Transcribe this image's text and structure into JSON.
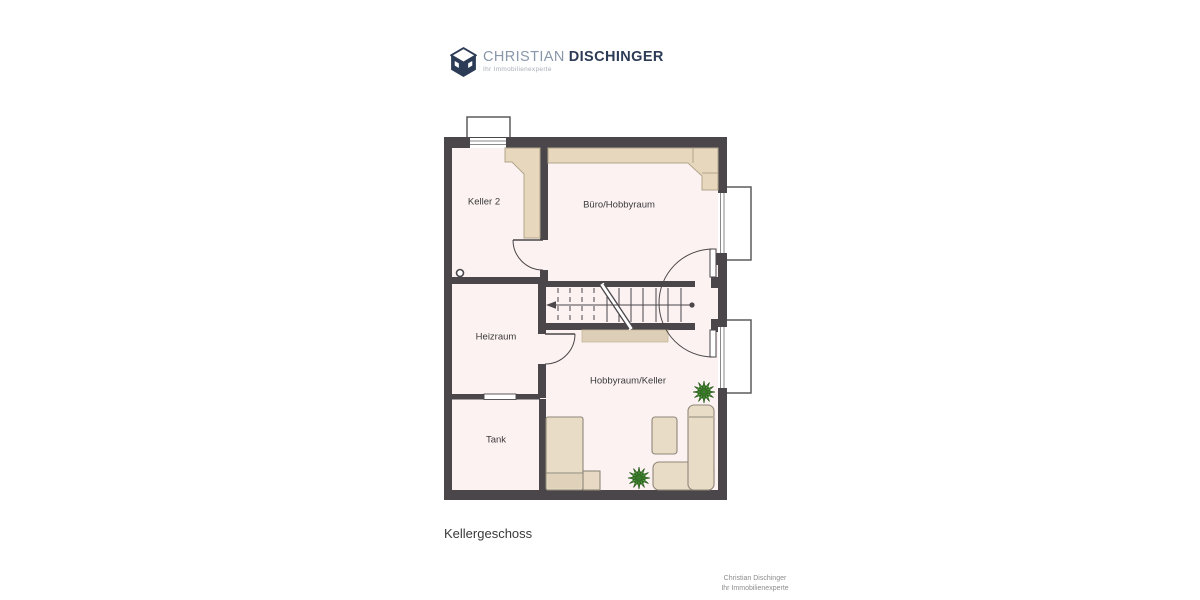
{
  "logo": {
    "brand_first": "CHRISTIAN",
    "brand_second": "DISCHINGER",
    "tagline": "Ihr Immobilienexperte"
  },
  "floorplan": {
    "title": "Kellergeschoss",
    "rooms": [
      {
        "label": "Keller 2"
      },
      {
        "label": "Büro/Hobbyraum"
      },
      {
        "label": "Heizraum"
      },
      {
        "label": "Hobbyraum/Keller"
      },
      {
        "label": "Tank"
      }
    ]
  },
  "footer": {
    "line1": "Christian Dischinger",
    "line2": "Ihr Immobilienexperte"
  },
  "colors": {
    "wall": "#4a4649",
    "floor": "#fcf2f2",
    "furniture": "#e9dcc7",
    "furniture_border": "#8f8779",
    "counter": "#e6d7bd",
    "understair": "#ddcfb7",
    "plant_green": "#55a13c",
    "plant_dark": "#2b5d20",
    "brand_navy": "#2d3c56",
    "brand_gray": "#8897a9"
  }
}
